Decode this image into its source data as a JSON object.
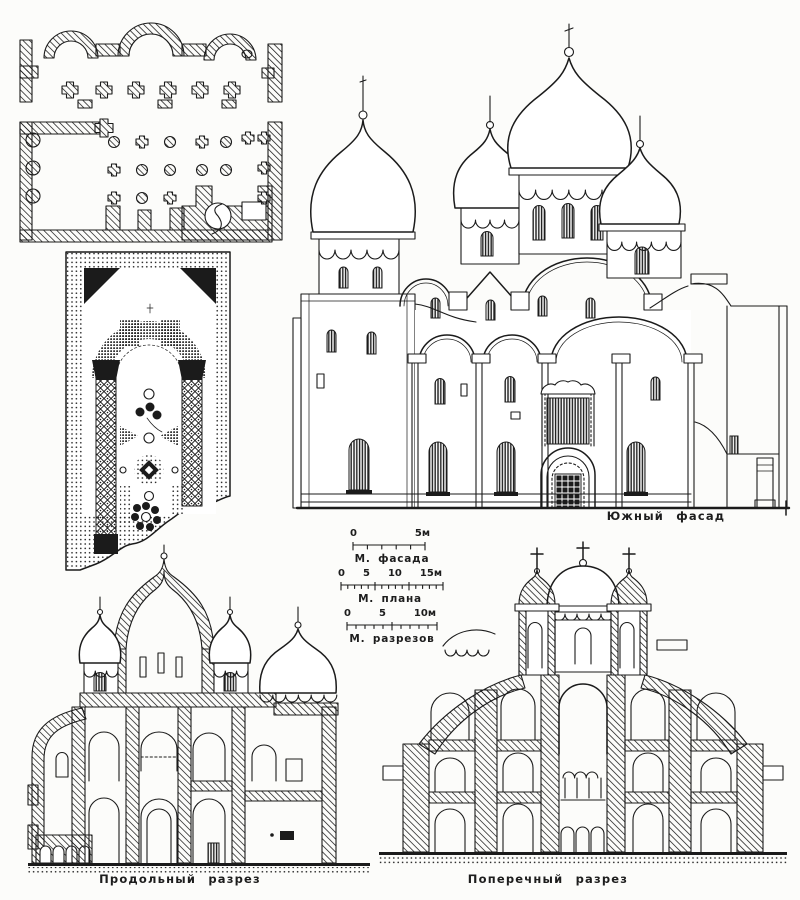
{
  "page": {
    "paper_color": "#fcfcfa",
    "ink_color": "#1b1b1b"
  },
  "captions": {
    "south_facade": "Южный фасад",
    "longitudinal_section": "Продольный разрез",
    "transverse_section": "Поперечный разрез"
  },
  "scale_bars": [
    {
      "id": "facade-scale",
      "label": "М. фасада",
      "ticks": [
        "0",
        "5м"
      ]
    },
    {
      "id": "plan-scale",
      "label": "М. плана",
      "ticks": [
        "0",
        "5",
        "10",
        "15м"
      ]
    },
    {
      "id": "sections-scale",
      "label": "М. разрезов",
      "ticks": [
        "0",
        "5",
        "10м"
      ]
    }
  ]
}
